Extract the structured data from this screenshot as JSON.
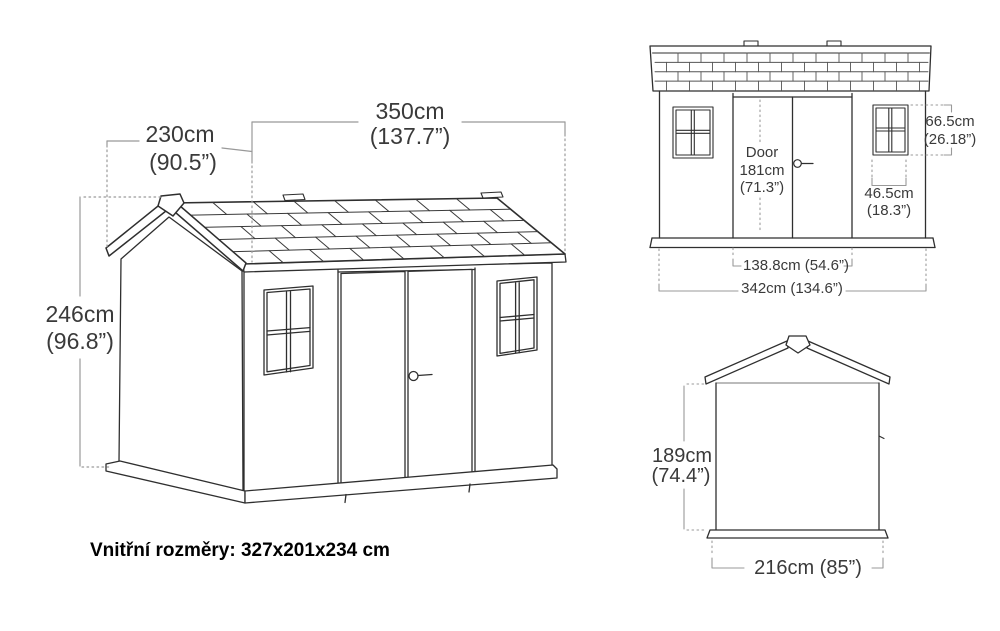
{
  "iso_view": {
    "length_cm": "350cm",
    "length_in": "(137.7”)",
    "depth_cm": "230cm",
    "depth_in": "(90.5”)",
    "height_cm": "246cm",
    "height_in": "(96.8”)"
  },
  "front_view": {
    "door_label": "Door",
    "door_height_cm": "181cm",
    "door_height_in": "(71.3”)",
    "window_height_cm": "66.5cm",
    "window_height_in": "(26.18”)",
    "window_width_cm": "46.5cm",
    "window_width_in": "(18.3”)",
    "door_opening_width": "138.8cm (54.6”)",
    "overall_width": "342cm (134.6”)"
  },
  "side_view": {
    "wall_height_cm": "189cm",
    "wall_height_in": "(74.4”)",
    "overall_width": "216cm (85”)"
  },
  "footer": {
    "internal_dimensions": "Vnitřní rozměry: 327x201x234 cm"
  },
  "colors": {
    "outline": "#2f2f2f",
    "dimension": "#999999",
    "text": "#3a3a3a"
  }
}
